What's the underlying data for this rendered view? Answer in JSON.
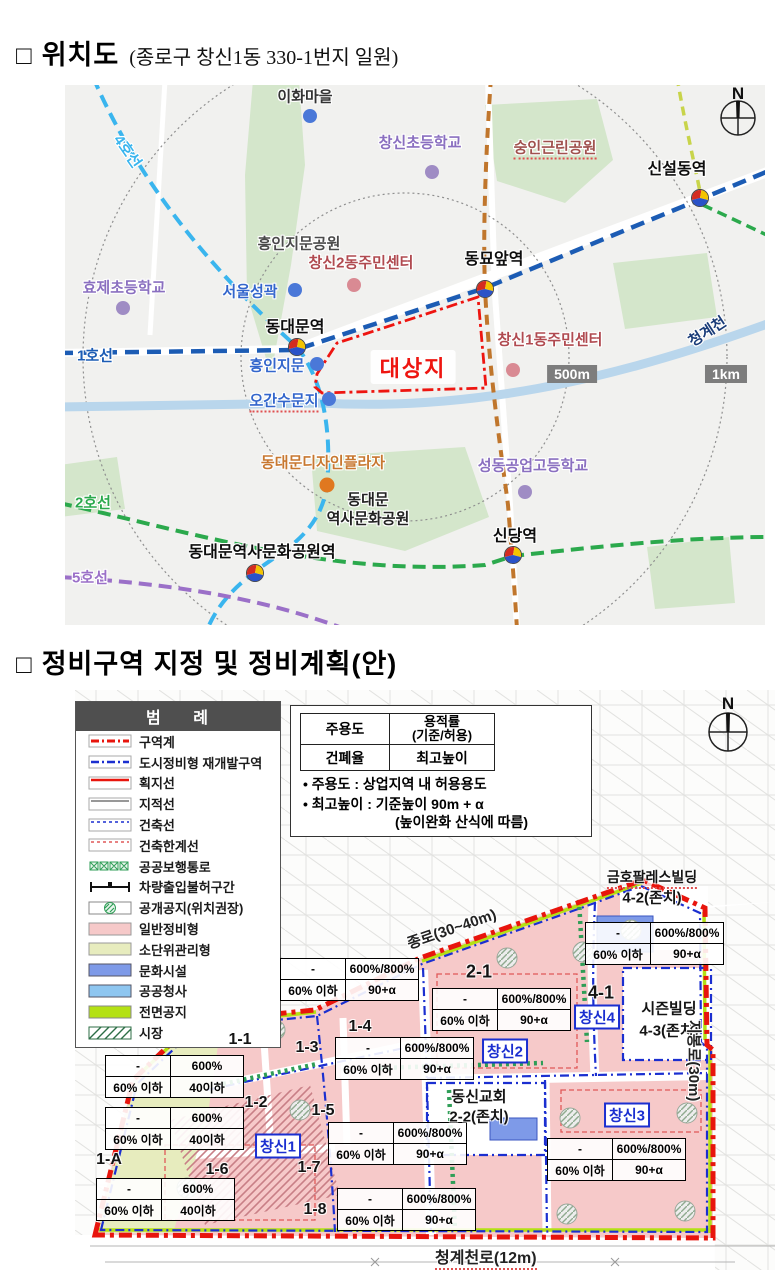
{
  "colors": {
    "boundary_red": "#e8150d",
    "zone_pink": "#f6c9c9",
    "small_unit_green": "#e7ecbe",
    "culture_blue": "#7e9ae8",
    "public_blue": "#8ec6f0",
    "front_lime": "#b4e114",
    "line1": "#1c5cb4",
    "line2": "#2ba94c",
    "line4": "#3ab5ee",
    "line5": "#9b70c8"
  },
  "sec1": {
    "bullet": "□",
    "title": "위치도",
    "subtitle": "(종로구 창신1동 330-1번지 일원)"
  },
  "sec2": {
    "bullet": "□",
    "title": "정비구역 지정 및 정비계획(안)"
  },
  "map1": {
    "compass": "N",
    "labels": {
      "ihwa": "이화마을",
      "changsin_elem": "창신초등학교",
      "sungin_park": "숭인근린공원",
      "sinseol": "신설동역",
      "heunginji_park": "흥인지문공원",
      "cs2_center": "창신2동주민센터",
      "dongmyo": "동묘앞역",
      "hyoje_elem": "효제초등학교",
      "seoul_wall": "서울성곽",
      "ddm_stn": "동대문역",
      "cs1_center": "창신1동주민센터",
      "cheonggye": "청계천",
      "line1": "1호선",
      "target": "대상지",
      "heunginjimun": "흥인지문",
      "scale500": "500m",
      "scale1km": "1km",
      "ogansu": "오간수문지",
      "line4": "4호선",
      "ddp": "동대문디자인플라자",
      "ddm_hist1": "동대문",
      "ddm_hist2": "역사문화공원",
      "line2": "2호선",
      "ddmhcp_stn": "동대문역사문화공원역",
      "sindang": "신당역",
      "seongdong_hs": "성동공업고등학교",
      "line5": "5호선"
    }
  },
  "map2": {
    "compass": "N",
    "legend": {
      "title": "범  례",
      "items": [
        "구역계",
        "도시정비형 재개발구역",
        "획지선",
        "지적선",
        "건축선",
        "건축한계선",
        "공공보행통로",
        "차량출입불허구간",
        "공개공지(위치권장)",
        "일반정비형",
        "소단위관리형",
        "문화시설",
        "공공청사",
        "전면공지",
        "시장"
      ]
    },
    "keybox": {
      "r1c1": "주용도",
      "r1c2a": "용적률",
      "r1c2b": "(기준/허용)",
      "r2c1": "건폐율",
      "r2c2": "최고높이",
      "note1": "•  주용도 : 상업지역 내 허용용도",
      "note2": "•  최고높이 : 기준높이 90m + α",
      "note3": "(높이완화 산식에 따름)"
    },
    "table_a": {
      "use": "-",
      "far": "600%/800%",
      "bcr": "60% 이하",
      "height": "90+α"
    },
    "table_b": {
      "use": "-",
      "far": "600%",
      "bcr": "60% 이하",
      "height": "40이하"
    },
    "zones": {
      "z11": "1-1",
      "z12": "1-2",
      "z13": "1-3",
      "z14": "1-4",
      "z15": "1-5",
      "z16": "1-6",
      "z17": "1-7",
      "z18": "1-8",
      "z1a": "1-A",
      "z21": "2-1",
      "z41": "4-1",
      "kumho": "금호팔레스빌딩",
      "z42": "4-2(존치)",
      "season": "시즌빌딩",
      "z43": "4-3(존치)",
      "dongsin": "동신교회",
      "z22": "2-2(존치)"
    },
    "boxed": {
      "cs1": "창신1",
      "cs2": "창신2",
      "cs3": "창신3",
      "cs4": "창신4"
    },
    "roads": {
      "jongno": "종로(30~40m)",
      "jibong": "지봉로(30m)",
      "cheonggyecheonro": "청계천로(12m)"
    }
  }
}
